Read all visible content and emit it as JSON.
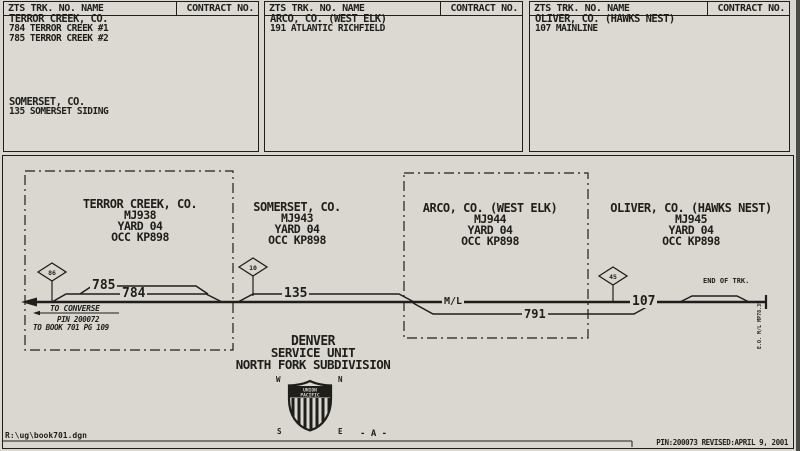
{
  "colors": {
    "paper": "#d9d7d0",
    "ink": "#1f1e1a"
  },
  "contract_boxes": [
    {
      "header_left": "ZTS TRK. NO. NAME",
      "header_right": "CONTRACT NO.",
      "groups": [
        {
          "title": "TERROR CREEK, CO.",
          "lines": [
            "784 TERROR CREEK #1",
            "785 TERROR CREEK #2"
          ]
        },
        {
          "title": "SOMERSET, CO.",
          "lines": [
            "135 SOMERSET SIDING"
          ]
        }
      ]
    },
    {
      "header_left": "ZTS TRK. NO. NAME",
      "header_right": "CONTRACT NO.",
      "groups": [
        {
          "title": "ARCO, CO. (WEST ELK)",
          "lines": [
            "191 ATLANTIC RICHFIELD"
          ]
        }
      ]
    },
    {
      "header_left": "ZTS TRK. NO. NAME",
      "header_right": "CONTRACT NO.",
      "groups": [
        {
          "title": "OLIVER, CO. (HAWKS NEST)",
          "lines": [
            "107 MAINLINE"
          ]
        }
      ]
    }
  ],
  "stations": [
    {
      "name": "TERROR CREEK, CO.",
      "unit": "MJ938",
      "yard": "YARD 04",
      "occ": "OCC KP898"
    },
    {
      "name": "SOMERSET, CO.",
      "unit": "MJ943",
      "yard": "YARD 04",
      "occ": "OCC KP898"
    },
    {
      "name": "ARCO, CO. (WEST ELK)",
      "unit": "MJ944",
      "yard": "YARD 04",
      "occ": "OCC KP898"
    },
    {
      "name": "OLIVER, CO. (HAWKS NEST)",
      "unit": "MJ945",
      "yard": "YARD 04",
      "occ": "OCC KP898"
    }
  ],
  "track": {
    "siding_785": "785",
    "siding_784": "784",
    "siding_135": "135",
    "track_791": "791",
    "track_107": "107",
    "mainline_label": "M/L",
    "markers": [
      {
        "value": "86"
      },
      {
        "value": "10"
      },
      {
        "value": "45"
      }
    ],
    "to_converse": "TO CONVERSE",
    "pin_ref": "PIN 200072",
    "book_ref": "TO BOOK 701 PG 109",
    "end_of_track": "END OF TRK.",
    "end_note": "E.O. M/L MP78.39"
  },
  "title_block": {
    "line1": "DENVER",
    "line2": "SERVICE UNIT",
    "line3": "NORTH FORK SUBDIVISION"
  },
  "compass": {
    "w": "W",
    "n": "N",
    "s": "S",
    "e": "E"
  },
  "logo": {
    "top": "UNION",
    "bottom": "PACIFIC"
  },
  "page_marker": "- A -",
  "footer": {
    "file": "R:\\ug\\book701.dgn",
    "revision": "PIN:200073 REVISED:APRIL 9, 2001"
  }
}
